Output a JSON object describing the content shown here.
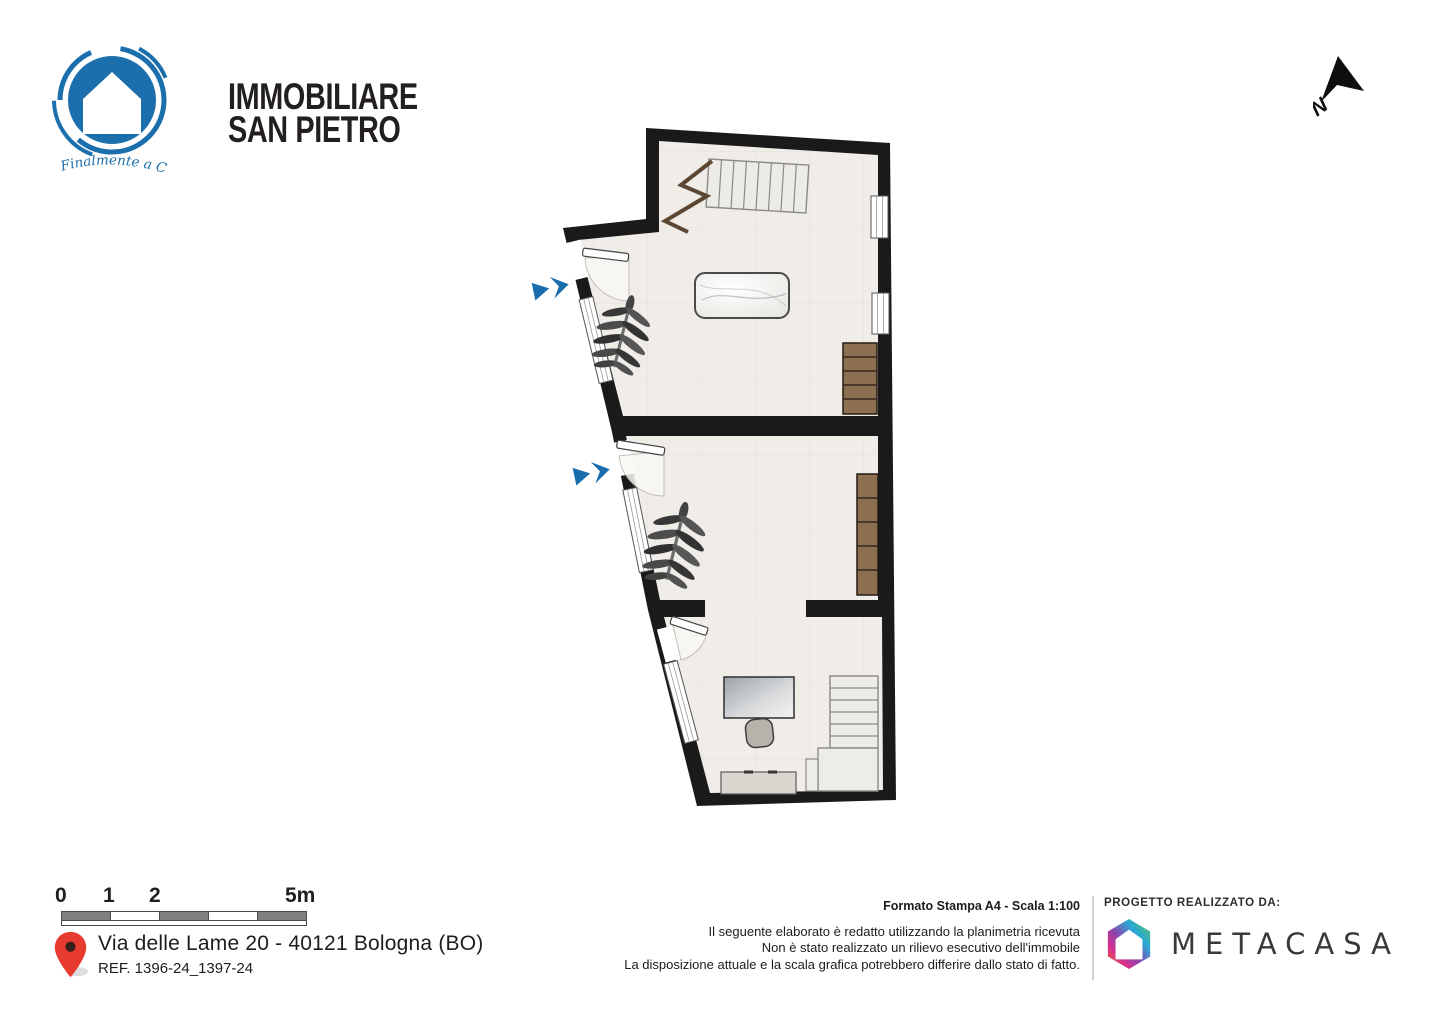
{
  "branding": {
    "name_line1": "IMMOBILIARE",
    "name_line2": "SAN PIETRO",
    "tagline": "Finalmente a Casa",
    "brand_blue": "#1b6fad",
    "text_color": "#231f20"
  },
  "compass": {
    "label": "N"
  },
  "floor_plan": {
    "wall_color": "#1a1a1a",
    "floor_color": "#f0ede9",
    "wood_color": "#8d6f52",
    "entrance_arrow_color": "#1a6dad"
  },
  "scale_bar": {
    "labels": [
      "0",
      "1",
      "2",
      "5m"
    ]
  },
  "address": {
    "line1": "Via delle Lame 20 - 40121 Bologna (BO)",
    "ref": "REF. 1396-24_1397-24"
  },
  "print_info": {
    "format_line": "Formato Stampa A4 - Scala 1:100",
    "disclaimer_lines": [
      "Il seguente elaborato è redatto utilizzando la planimetria ricevuta",
      "Non è stato realizzato un rilievo esecutivo dell'immobile",
      "La disposizione attuale e la scala grafica potrebbero differire dallo stato di fatto."
    ]
  },
  "credits": {
    "heading": "PROGETTO REALIZZATO DA:",
    "company": "METACASA"
  }
}
